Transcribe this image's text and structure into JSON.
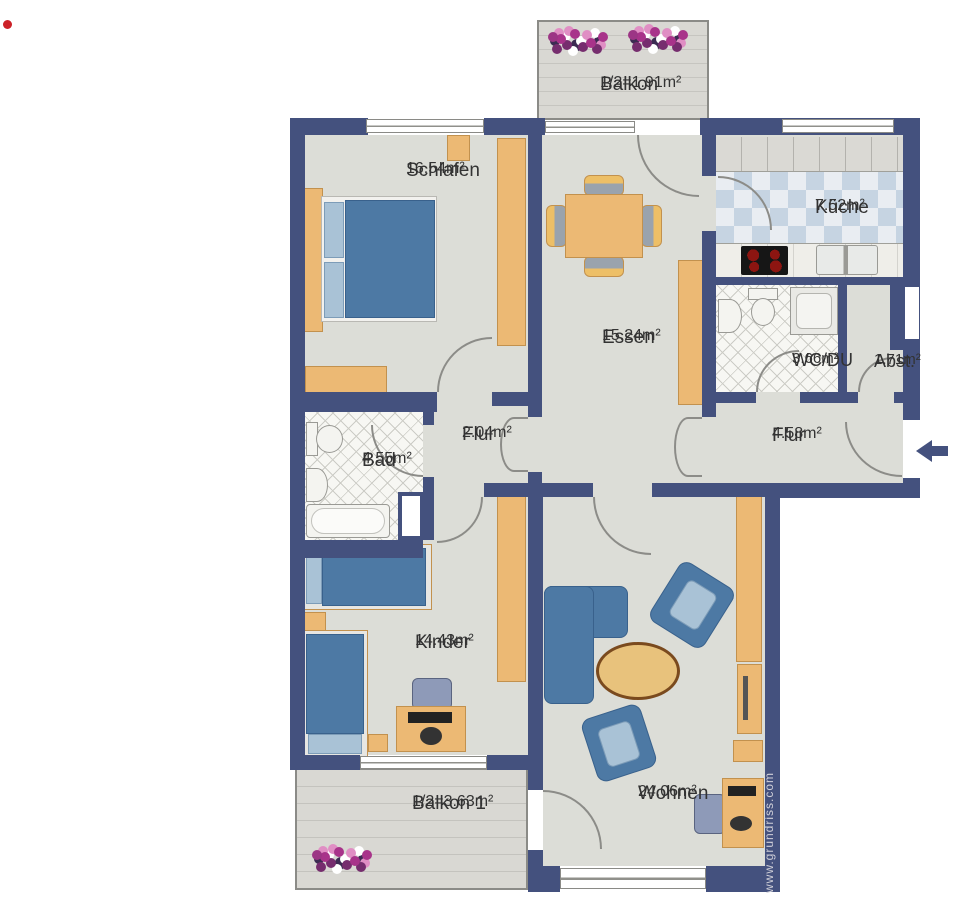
{
  "plan": {
    "type": "apartment-floor-plan",
    "watermark": "www.grundriss.com",
    "entrance_arrow": {
      "direction": "left",
      "color": "#44517e"
    },
    "marker_dot_color": "#cc2128",
    "colors": {
      "wall": "#44517e",
      "floor": "#dcddd7",
      "wood_furniture": "#ecb974",
      "upholstery_blue": "#4d79a4",
      "kitchen_tile_blue": "#c6d4e2",
      "balcony_deck": "#d9d8d3"
    }
  },
  "rooms": [
    {
      "id": "schlafen",
      "name": "Schlafen",
      "area": "16.54m²"
    },
    {
      "id": "essen",
      "name": "Essen",
      "area": "15.24m²"
    },
    {
      "id": "kueche",
      "name": "Küche",
      "area": "7.52m²"
    },
    {
      "id": "wcdu",
      "name": "WC/DU",
      "area": "3.66m²"
    },
    {
      "id": "abst",
      "name": "Abst.",
      "area": "1.71m²"
    },
    {
      "id": "flur-klein",
      "name": "Flur",
      "area": "2.04m²"
    },
    {
      "id": "flur-gross",
      "name": "Flur",
      "area": "4.58m²"
    },
    {
      "id": "bad",
      "name": "Bad",
      "area": "4.55m²"
    },
    {
      "id": "kinder",
      "name": "Kinder",
      "area": "14.43m²"
    },
    {
      "id": "wohnen",
      "name": "Wohnen",
      "area": "24.06m²"
    },
    {
      "id": "balkon",
      "name": "Balkon",
      "area": "1/2=1.91m²"
    },
    {
      "id": "balkon1",
      "name": "Balkon 1",
      "area": "1/2=3.63m²"
    }
  ],
  "icons": [
    "double-bed-icon",
    "single-bed-icon",
    "wardrobe-icon",
    "sideboard-icon",
    "dining-table-icon",
    "chair-icon",
    "sofa-icon",
    "armchair-icon",
    "coffee-table-icon",
    "desk-icon",
    "desk-chair-icon",
    "toilet-icon",
    "washbasin-icon",
    "bathtub-icon",
    "shower-icon",
    "cooktop-icon",
    "kitchen-sink-icon",
    "flower-pot-icon",
    "entrance-arrow-icon",
    "door-swing-arc",
    "window"
  ]
}
